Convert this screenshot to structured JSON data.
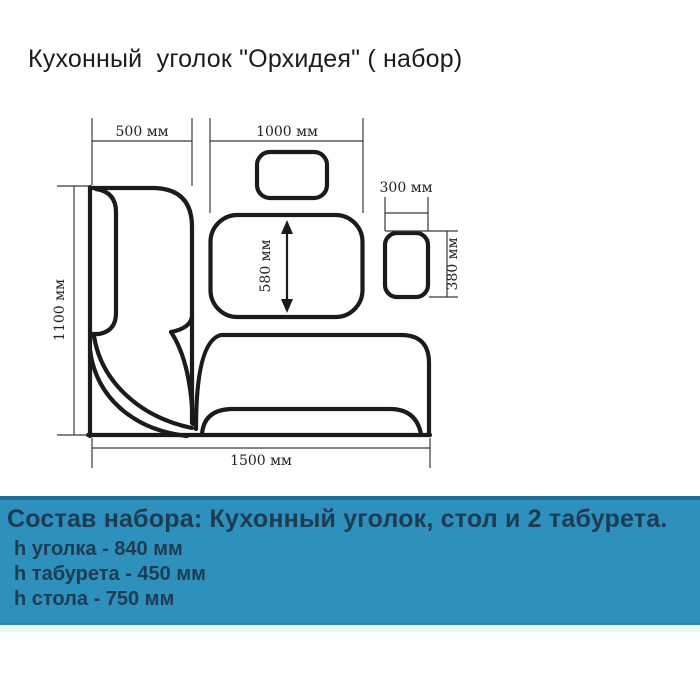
{
  "title": "Кухонный  уголок \"Орхидея\" ( набор)",
  "diagram": {
    "labels": {
      "bench_left_width": "500 мм",
      "table_length": "1000 мм",
      "stool_width": "300 мм",
      "stool_depth": "380 мм",
      "table_width": "580 мм",
      "bench_depth": "1100 мм",
      "bench_length": "1500 мм"
    }
  },
  "info_panel": {
    "heading": "Состав набора: Кухонный уголок, стол и 2 табурета.",
    "lines": [
      "h уголка - 840 мм",
      "h табурета - 450 мм",
      "h стола - 750 мм"
    ],
    "colors": {
      "background": "#2e90bc",
      "border_top": "#1e6f96",
      "text": "#1d3c52",
      "line_color": "#1b1b1b"
    }
  }
}
